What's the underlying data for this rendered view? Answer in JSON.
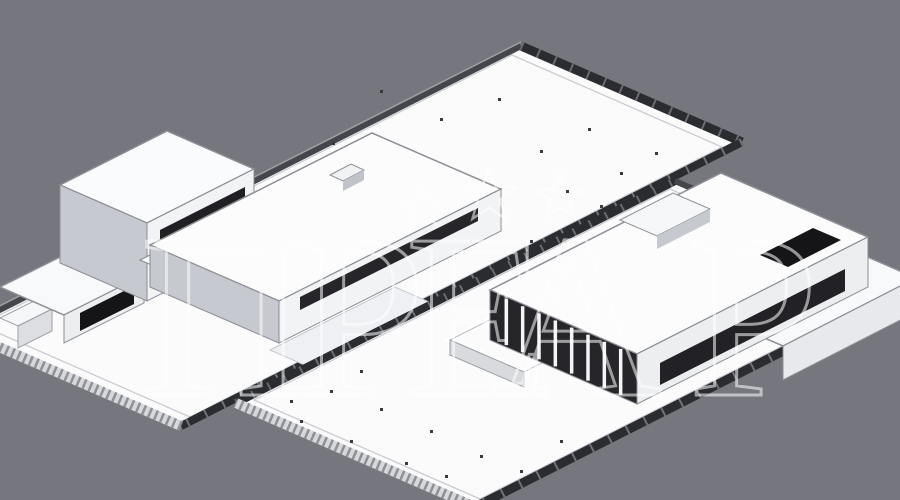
{
  "labels": {
    "front_view": {
      "line1": "Общий вид",
      "line2": "на передний двор"
    },
    "back_view": {
      "line1": "Общий вид",
      "line2": "на задний двор"
    }
  },
  "watermark": {
    "letters": [
      "П",
      "Р",
      "Е",
      "А",
      "Р"
    ],
    "star_count": 3
  },
  "scene": {
    "views": [
      {
        "name": "axonometric-view-front-yard"
      },
      {
        "name": "axonometric-view-back-yard"
      }
    ]
  },
  "colors": {
    "background_gray": "#75767e",
    "column_tan": "#ecc28d",
    "column_salmon": "#eeab8d",
    "plot_white": "#fbfbfc",
    "fence_dark": "#2b2c30",
    "facade_light": "#f2f3f5",
    "facade_shadow": "#c6c9cf",
    "window_dark": "#1d1d21",
    "label_front_text": "#c9bd9b",
    "label_back_text": "#c5c4d0",
    "watermark_stroke": "#ffffff"
  }
}
